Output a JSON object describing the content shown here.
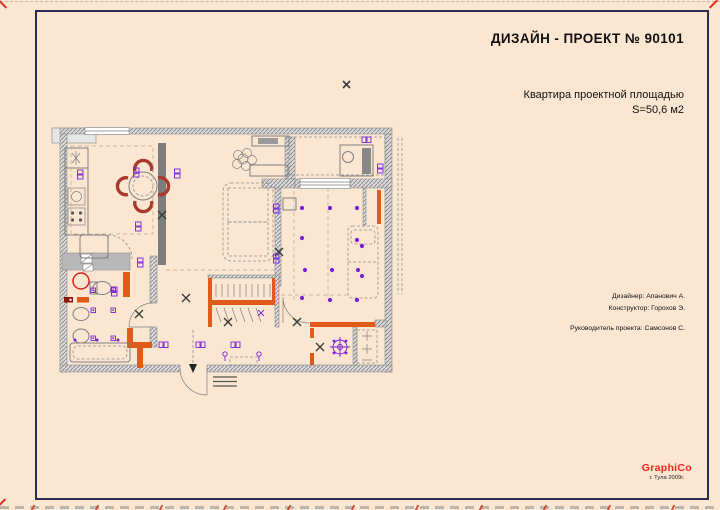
{
  "header": {
    "title": "ДИЗАЙН - ПРОЕКТ  № 90101",
    "subtitle_line1": "Квартира проектной площадью",
    "subtitle_line2": "S=50,6 м2"
  },
  "credits": {
    "designer": "Дизайнер:  Апанович А.",
    "constructor": "Конструктор: Горохов Э.",
    "manager": "Руководитель проекта: Самсонов С."
  },
  "brand": {
    "name": "GraphiCo",
    "location": "г. Тула  2009г."
  },
  "plan": {
    "colors": {
      "paper": "#fbe7d1",
      "frame": "#2b2b50",
      "wall_gray": "#8f8f8f",
      "new_wall_orange": "#e05a18",
      "lighting_purple": "#7b1fd6",
      "chair_red": "#a93a2c",
      "logo_red": "#f2241c"
    }
  }
}
